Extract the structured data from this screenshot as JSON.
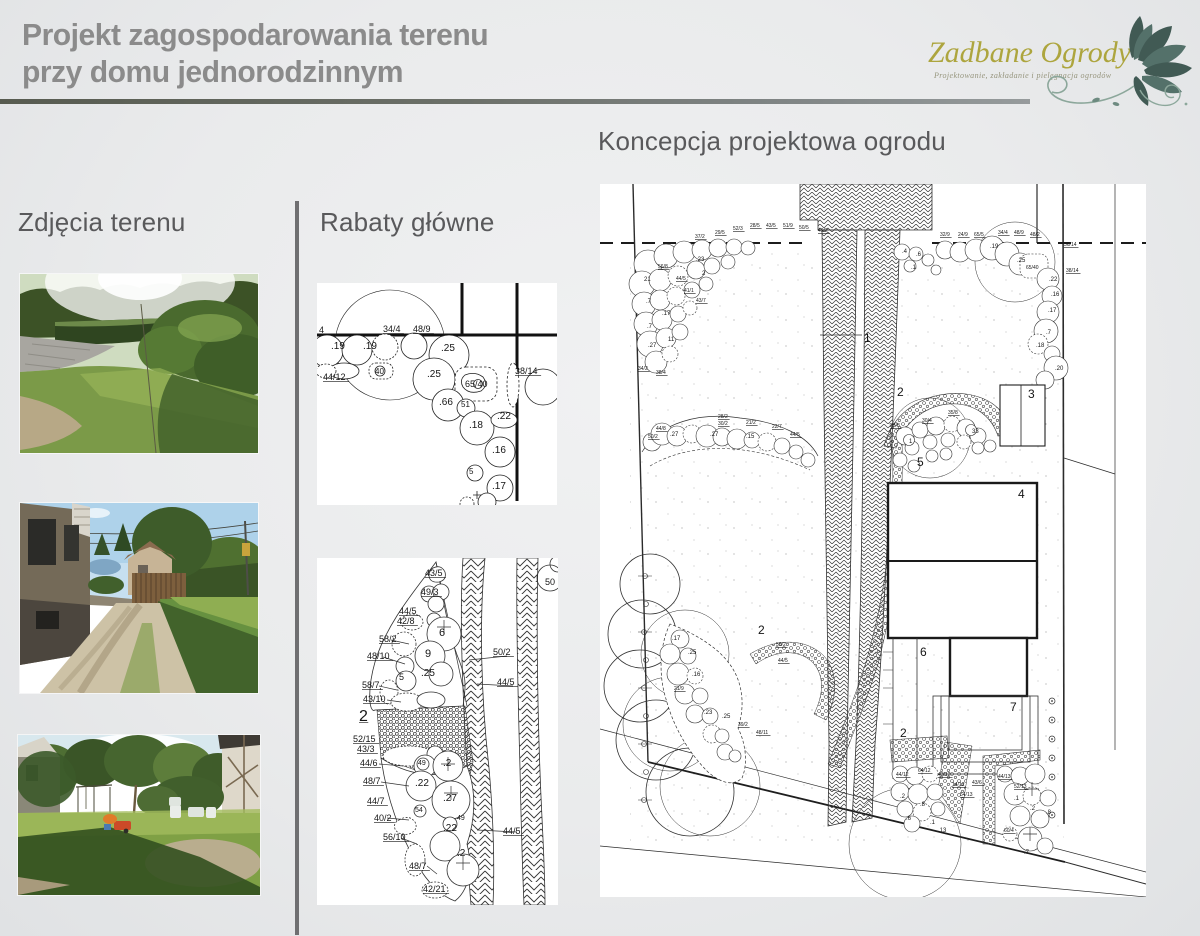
{
  "header": {
    "title_line1": "Projekt zagospodarowania terenu",
    "title_line2": "przy domu jednorodzinnym",
    "logo_name": "Zadbane Ogrody",
    "logo_tagline": "Projektowanie, zakładanie i pielęgnacja ogrodów"
  },
  "sections": {
    "photos": "Zdjęcia terenu",
    "beds": "Rabaty główne",
    "plan": "Koncepcja projektowa ogrodu"
  },
  "colors": {
    "accent_olive": "#ada53e",
    "leaf_green": "#415a54",
    "title_gray": "#8b8b8b",
    "heading_gray": "#59595b"
  },
  "bed1": {
    "labels": [
      {
        "x": 2,
        "y": 50,
        "t": "4",
        "s": 9,
        "u": 1
      },
      {
        "x": 14,
        "y": 66,
        "t": ".19",
        "s": 10
      },
      {
        "x": 46,
        "y": 66,
        "t": ".19",
        "s": 10
      },
      {
        "x": 66,
        "y": 49,
        "t": "34/4",
        "s": 9,
        "u": 1
      },
      {
        "x": 96,
        "y": 49,
        "t": "48/9",
        "s": 9,
        "u": 1
      },
      {
        "x": 124,
        "y": 68,
        "t": ".25",
        "s": 10
      },
      {
        "x": 6,
        "y": 97,
        "t": "44/12",
        "s": 9,
        "u": 1
      },
      {
        "x": 58,
        "y": 91,
        "t": "40",
        "s": 8
      },
      {
        "x": 110,
        "y": 94,
        "t": ".25",
        "s": 10
      },
      {
        "x": 148,
        "y": 104,
        "t": "65/40",
        "s": 9
      },
      {
        "x": 198,
        "y": 91,
        "t": "38/14",
        "s": 9,
        "u": 1
      },
      {
        "x": 122,
        "y": 122,
        "t": ".66",
        "s": 10
      },
      {
        "x": 144,
        "y": 124,
        "t": "51",
        "s": 8
      },
      {
        "x": 152,
        "y": 145,
        "t": ".18",
        "s": 10
      },
      {
        "x": 180,
        "y": 136,
        "t": ".22",
        "s": 10
      },
      {
        "x": 175,
        "y": 170,
        "t": ".16",
        "s": 10
      },
      {
        "x": 152,
        "y": 191,
        "t": "5",
        "s": 8
      },
      {
        "x": 175,
        "y": 206,
        "t": ".17",
        "s": 10
      }
    ]
  },
  "bed2": {
    "labels": [
      {
        "x": 108,
        "y": 18,
        "t": "43/5",
        "s": 9,
        "u": 1
      },
      {
        "x": 104,
        "y": 37,
        "t": "49/3",
        "s": 9,
        "u": 1
      },
      {
        "x": 82,
        "y": 56,
        "t": "44/5",
        "s": 9,
        "u": 1
      },
      {
        "x": 80,
        "y": 66,
        "t": "42/8",
        "s": 9,
        "u": 1
      },
      {
        "x": 122,
        "y": 78,
        "t": "6",
        "s": 11
      },
      {
        "x": 62,
        "y": 84,
        "t": "58/2",
        "s": 9,
        "u": 1
      },
      {
        "x": 108,
        "y": 99,
        "t": "9",
        "s": 11
      },
      {
        "x": 50,
        "y": 101,
        "t": "48/10",
        "s": 9,
        "u": 1
      },
      {
        "x": 176,
        "y": 97,
        "t": "50/2",
        "s": 9,
        "u": 1
      },
      {
        "x": 104,
        "y": 118,
        "t": ".25",
        "s": 10
      },
      {
        "x": 82,
        "y": 122,
        "t": "5",
        "s": 9
      },
      {
        "x": 180,
        "y": 127,
        "t": "44/5",
        "s": 9,
        "u": 1
      },
      {
        "x": 45,
        "y": 130,
        "t": "58/7",
        "s": 9,
        "u": 1
      },
      {
        "x": 46,
        "y": 144,
        "t": "43/10",
        "s": 9,
        "u": 1
      },
      {
        "x": 42,
        "y": 163,
        "t": "2",
        "s": 16,
        "u": 1
      },
      {
        "x": 228,
        "y": 27,
        "t": "50",
        "s": 9
      },
      {
        "x": 36,
        "y": 184,
        "t": "52/15",
        "s": 9,
        "u": 1
      },
      {
        "x": 40,
        "y": 194,
        "t": "43/3",
        "s": 9,
        "u": 1
      },
      {
        "x": 43,
        "y": 208,
        "t": "44/6",
        "s": 9,
        "u": 1
      },
      {
        "x": 101,
        "y": 207,
        "t": "49",
        "s": 7
      },
      {
        "x": 126,
        "y": 208,
        "t": ".2",
        "s": 10
      },
      {
        "x": 46,
        "y": 226,
        "t": "48/7",
        "s": 9,
        "u": 1
      },
      {
        "x": 98,
        "y": 228,
        "t": ".22",
        "s": 10
      },
      {
        "x": 126,
        "y": 243,
        "t": ".27",
        "s": 10
      },
      {
        "x": 50,
        "y": 246,
        "t": "44/7",
        "s": 9,
        "u": 1
      },
      {
        "x": 98,
        "y": 254,
        "t": "54",
        "s": 7
      },
      {
        "x": 57,
        "y": 263,
        "t": "40/2",
        "s": 9,
        "u": 1
      },
      {
        "x": 140,
        "y": 262,
        "t": "49",
        "s": 7
      },
      {
        "x": 126,
        "y": 273,
        "t": ".22",
        "s": 10
      },
      {
        "x": 66,
        "y": 282,
        "t": "56/10",
        "s": 9,
        "u": 1
      },
      {
        "x": 186,
        "y": 276,
        "t": "44/5",
        "s": 9,
        "u": 1
      },
      {
        "x": 140,
        "y": 298,
        "t": ".2",
        "s": 10
      },
      {
        "x": 92,
        "y": 311,
        "t": "48/7",
        "s": 9,
        "u": 1
      },
      {
        "x": 106,
        "y": 334,
        "t": "42/21",
        "s": 9,
        "u": 1
      }
    ]
  },
  "plan": {
    "labels": [
      {
        "x": 264,
        "y": 158,
        "t": "1",
        "s": 12
      },
      {
        "x": 297,
        "y": 212,
        "t": "2",
        "s": 12
      },
      {
        "x": 428,
        "y": 214,
        "t": "3",
        "s": 12
      },
      {
        "x": 418,
        "y": 314,
        "t": "4",
        "s": 12
      },
      {
        "x": 317,
        "y": 282,
        "t": "5",
        "s": 12
      },
      {
        "x": 320,
        "y": 472,
        "t": "6",
        "s": 12
      },
      {
        "x": 410,
        "y": 527,
        "t": "7",
        "s": 12
      },
      {
        "x": 158,
        "y": 450,
        "t": "2",
        "s": 12
      },
      {
        "x": 300,
        "y": 553,
        "t": "2",
        "s": 12
      },
      {
        "x": 95,
        "y": 54,
        "t": "37/2",
        "s": 5,
        "u": 1
      },
      {
        "x": 115,
        "y": 50,
        "t": "29/5",
        "s": 5,
        "u": 1
      },
      {
        "x": 133,
        "y": 46,
        "t": "52/3",
        "s": 5,
        "u": 1
      },
      {
        "x": 150,
        "y": 43,
        "t": "28/5",
        "s": 5,
        "u": 1
      },
      {
        "x": 166,
        "y": 43,
        "t": "43/5",
        "s": 5,
        "u": 1
      },
      {
        "x": 183,
        "y": 43,
        "t": "51/9",
        "s": 5,
        "u": 1
      },
      {
        "x": 199,
        "y": 45,
        "t": "50/5",
        "s": 5,
        "u": 1
      },
      {
        "x": 218,
        "y": 48,
        "t": "49/2",
        "s": 5,
        "u": 1
      },
      {
        "x": 340,
        "y": 52,
        "t": "32/9",
        "s": 5,
        "u": 1
      },
      {
        "x": 358,
        "y": 52,
        "t": "24/9",
        "s": 5,
        "u": 1
      },
      {
        "x": 374,
        "y": 52,
        "t": "65/5",
        "s": 5,
        "u": 1
      },
      {
        "x": 398,
        "y": 50,
        "t": "34/4",
        "s": 5,
        "u": 1
      },
      {
        "x": 414,
        "y": 50,
        "t": "48/9",
        "s": 5,
        "u": 1
      },
      {
        "x": 430,
        "y": 52,
        "t": "48/2",
        "s": 5,
        "u": 1
      },
      {
        "x": 464,
        "y": 62,
        "t": "36/14",
        "s": 5,
        "u": 1
      },
      {
        "x": 466,
        "y": 88,
        "t": "38/14",
        "s": 5,
        "u": 1
      },
      {
        "x": 390,
        "y": 64,
        "t": ".19",
        "s": 6
      },
      {
        "x": 417,
        "y": 78,
        "t": ".25",
        "s": 6
      },
      {
        "x": 426,
        "y": 85,
        "t": "65/40",
        "s": 5
      },
      {
        "x": 449,
        "y": 97,
        "t": ".22",
        "s": 6
      },
      {
        "x": 451,
        "y": 112,
        "t": ".16",
        "s": 6
      },
      {
        "x": 448,
        "y": 128,
        "t": ".17",
        "s": 6
      },
      {
        "x": 446,
        "y": 150,
        "t": ".7",
        "s": 6
      },
      {
        "x": 436,
        "y": 163,
        "t": ".18",
        "s": 6
      },
      {
        "x": 455,
        "y": 186,
        "t": ".20",
        "s": 6
      },
      {
        "x": 302,
        "y": 69,
        "t": ".4",
        "s": 6
      },
      {
        "x": 316,
        "y": 72,
        "t": ".6",
        "s": 6
      },
      {
        "x": 311,
        "y": 85,
        "t": ".1",
        "s": 6
      },
      {
        "x": 44,
        "y": 97,
        "t": "21",
        "s": 6
      },
      {
        "x": 46,
        "y": 119,
        "t": ".7",
        "s": 6
      },
      {
        "x": 62,
        "y": 131,
        "t": ".17",
        "s": 6
      },
      {
        "x": 47,
        "y": 144,
        "t": ".7",
        "s": 6
      },
      {
        "x": 48,
        "y": 163,
        "t": ".27",
        "s": 6
      },
      {
        "x": 68,
        "y": 157,
        "t": "11",
        "s": 6
      },
      {
        "x": 96,
        "y": 77,
        "t": ".23",
        "s": 6
      },
      {
        "x": 102,
        "y": 91,
        "t": "2",
        "s": 6
      },
      {
        "x": 58,
        "y": 84,
        "t": "56/8",
        "s": 5,
        "u": 1
      },
      {
        "x": 76,
        "y": 96,
        "t": "44/5",
        "s": 5,
        "u": 1
      },
      {
        "x": 84,
        "y": 108,
        "t": "41/1",
        "s": 5,
        "u": 1
      },
      {
        "x": 96,
        "y": 118,
        "t": "43/7",
        "s": 5,
        "u": 1
      },
      {
        "x": 38,
        "y": 186,
        "t": "34/2",
        "s": 5,
        "u": 1
      },
      {
        "x": 56,
        "y": 190,
        "t": "38/4",
        "s": 5,
        "u": 1
      },
      {
        "x": 70,
        "y": 252,
        "t": ".27",
        "s": 6
      },
      {
        "x": 110,
        "y": 252,
        "t": ".27",
        "s": 6
      },
      {
        "x": 146,
        "y": 254,
        "t": ".15",
        "s": 6
      },
      {
        "x": 118,
        "y": 234,
        "t": "28/2",
        "s": 5,
        "u": 1
      },
      {
        "x": 118,
        "y": 241,
        "t": "30/2",
        "s": 5,
        "u": 1
      },
      {
        "x": 146,
        "y": 240,
        "t": "21/2",
        "s": 5,
        "u": 1
      },
      {
        "x": 172,
        "y": 244,
        "t": "22/7",
        "s": 5,
        "u": 1
      },
      {
        "x": 56,
        "y": 246,
        "t": "44/8",
        "s": 5,
        "u": 1
      },
      {
        "x": 48,
        "y": 254,
        "t": "50/2",
        "s": 5,
        "u": 1
      },
      {
        "x": 190,
        "y": 252,
        "t": "44/5",
        "s": 5,
        "u": 1
      },
      {
        "x": 309,
        "y": 259,
        "t": "1",
        "s": 6
      },
      {
        "x": 372,
        "y": 249,
        "t": "33",
        "s": 6
      },
      {
        "x": 290,
        "y": 243,
        "t": "28/8",
        "s": 5,
        "u": 1
      },
      {
        "x": 348,
        "y": 230,
        "t": "35/8",
        "s": 5,
        "u": 1
      },
      {
        "x": 322,
        "y": 238,
        "t": "30/4",
        "s": 5,
        "u": 1
      },
      {
        "x": 72,
        "y": 456,
        "t": ".17",
        "s": 6
      },
      {
        "x": 88,
        "y": 470,
        "t": ".25",
        "s": 6
      },
      {
        "x": 92,
        "y": 492,
        "t": ".16",
        "s": 6
      },
      {
        "x": 74,
        "y": 506,
        "t": "21/9",
        "s": 5,
        "u": 1
      },
      {
        "x": 104,
        "y": 530,
        "t": ".23",
        "s": 6
      },
      {
        "x": 122,
        "y": 534,
        "t": ".25",
        "s": 6
      },
      {
        "x": 138,
        "y": 542,
        "t": "39/2",
        "s": 5,
        "u": 1
      },
      {
        "x": 156,
        "y": 550,
        "t": "48/11",
        "s": 5,
        "u": 1
      },
      {
        "x": 176,
        "y": 462,
        "t": "50/2",
        "s": 5,
        "u": 1
      },
      {
        "x": 178,
        "y": 478,
        "t": "44/5",
        "s": 5,
        "u": 1
      },
      {
        "x": 296,
        "y": 592,
        "t": "44/12",
        "s": 5,
        "u": 1
      },
      {
        "x": 318,
        "y": 588,
        "t": "64/12",
        "s": 5,
        "u": 1
      },
      {
        "x": 338,
        "y": 592,
        "t": "43/12",
        "s": 5,
        "u": 1
      },
      {
        "x": 352,
        "y": 602,
        "t": "14/12",
        "s": 5,
        "u": 1
      },
      {
        "x": 300,
        "y": 614,
        "t": ".2",
        "s": 6
      },
      {
        "x": 320,
        "y": 622,
        "t": ".8",
        "s": 6
      },
      {
        "x": 306,
        "y": 636,
        "t": ".6",
        "s": 6
      },
      {
        "x": 330,
        "y": 640,
        "t": ".1",
        "s": 6
      },
      {
        "x": 338,
        "y": 648,
        "t": ".13",
        "s": 6
      },
      {
        "x": 372,
        "y": 600,
        "t": "43/6",
        "s": 5,
        "u": 1
      },
      {
        "x": 360,
        "y": 612,
        "t": "54/13",
        "s": 5,
        "u": 1
      },
      {
        "x": 398,
        "y": 594,
        "t": "44/13",
        "s": 5,
        "u": 1
      },
      {
        "x": 414,
        "y": 604,
        "t": "52/13",
        "s": 5,
        "u": 1
      },
      {
        "x": 414,
        "y": 616,
        "t": ".1",
        "s": 6
      },
      {
        "x": 430,
        "y": 626,
        "t": ".2",
        "s": 6
      },
      {
        "x": 446,
        "y": 630,
        "t": ".8",
        "s": 6
      },
      {
        "x": 404,
        "y": 648,
        "t": "60/4",
        "s": 5,
        "u": 1
      },
      {
        "x": 424,
        "y": 670,
        "t": ".7",
        "s": 6
      }
    ]
  }
}
